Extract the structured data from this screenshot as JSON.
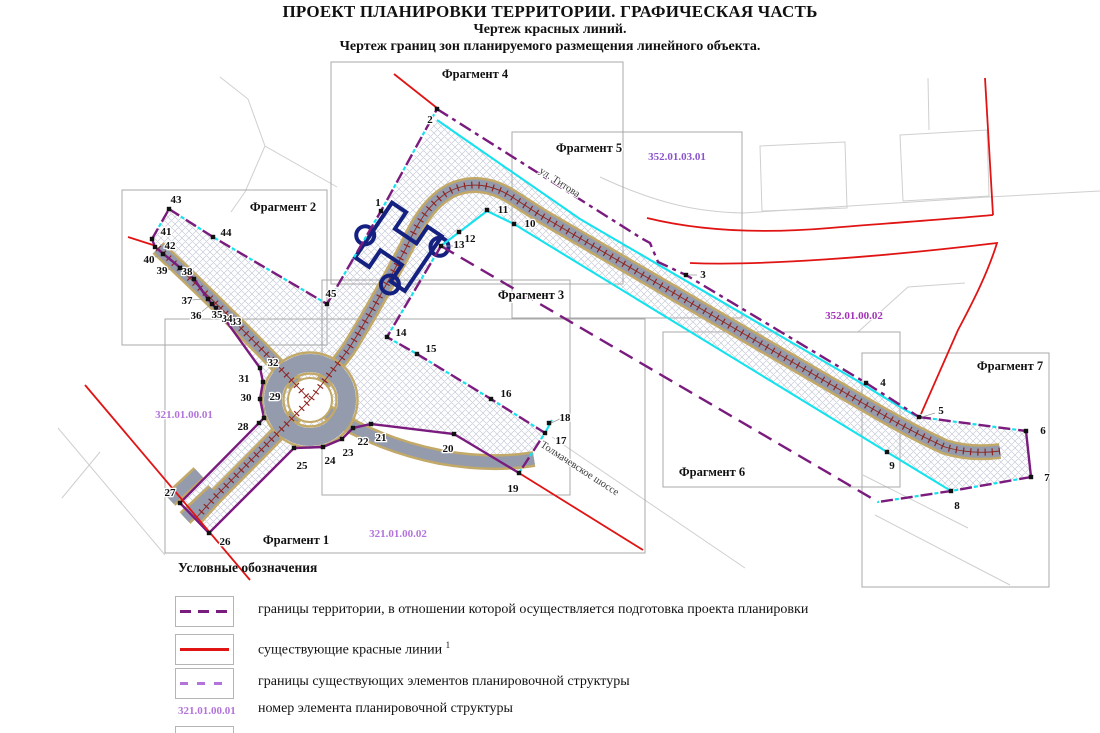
{
  "title": {
    "line1": "ПРОЕКТ ПЛАНИРОВКИ ТЕРРИТОРИИ. ГРАФИЧЕСКАЯ ЧАСТЬ",
    "line2": "Чертеж красных линий.",
    "line3": "Чертеж границ зон планируемого размещения линейного объекта."
  },
  "fragments": [
    {
      "label": "Фрагмент 1"
    },
    {
      "label": "Фрагмент 2"
    },
    {
      "label": "Фрагмент 3"
    },
    {
      "label": "Фрагмент 4"
    },
    {
      "label": "Фрагмент 5"
    },
    {
      "label": "Фрагмент 6"
    },
    {
      "label": "Фрагмент 7"
    }
  ],
  "zones": [
    {
      "code": "321.01.00.01"
    },
    {
      "code": "321.01.00.02"
    },
    {
      "code": "352.01.03.01"
    },
    {
      "code": "352.01.00.02"
    }
  ],
  "streets": [
    {
      "name": "ул. Титова"
    },
    {
      "name": "Толмачевское шоссе"
    }
  ],
  "legend": {
    "heading": "Условные обозначения",
    "items": [
      {
        "swatch": "boundary-dashed",
        "label": "границы территории, в отношении которой осуществляется подготовка проекта планировки"
      },
      {
        "swatch": "red-line",
        "label": "существующие красные линии",
        "superscript": "1"
      },
      {
        "swatch": "struct-dashed",
        "label": "границы существующих элементов планировочной структуры"
      },
      {
        "swatch": "code",
        "code": "321.01.00.01",
        "label": "номер элемента планировочной структуры"
      }
    ]
  },
  "points": [
    {
      "n": 1,
      "x": 381,
      "y": 211,
      "lx": 378,
      "ly": 206
    },
    {
      "n": 2,
      "x": 437,
      "y": 109,
      "lx": 430,
      "ly": 123
    },
    {
      "n": 3,
      "x": 686,
      "y": 275,
      "lx": 703,
      "ly": 278
    },
    {
      "n": 4,
      "x": 866,
      "y": 383,
      "lx": 883,
      "ly": 386
    },
    {
      "n": 5,
      "x": 919,
      "y": 417,
      "lx": 941,
      "ly": 414
    },
    {
      "n": 6,
      "x": 1026,
      "y": 431,
      "lx": 1043,
      "ly": 434
    },
    {
      "n": 7,
      "x": 1031,
      "y": 477,
      "lx": 1047,
      "ly": 481
    },
    {
      "n": 8,
      "x": 951,
      "y": 491,
      "lx": 957,
      "ly": 509
    },
    {
      "n": 9,
      "x": 887,
      "y": 452,
      "lx": 892,
      "ly": 469
    },
    {
      "n": 10,
      "x": 514,
      "y": 224,
      "lx": 530,
      "ly": 227
    },
    {
      "n": 11,
      "x": 487,
      "y": 210,
      "lx": 503,
      "ly": 213
    },
    {
      "n": 12,
      "x": 459,
      "y": 232,
      "lx": 470,
      "ly": 242
    },
    {
      "n": 13,
      "x": 441,
      "y": 246,
      "lx": 459,
      "ly": 248
    },
    {
      "n": 14,
      "x": 387,
      "y": 337,
      "lx": 401,
      "ly": 336
    },
    {
      "n": 15,
      "x": 417,
      "y": 354,
      "lx": 431,
      "ly": 352
    },
    {
      "n": 16,
      "x": 491,
      "y": 399,
      "lx": 506,
      "ly": 397
    },
    {
      "n": 17,
      "x": 545,
      "y": 433,
      "lx": 561,
      "ly": 444
    },
    {
      "n": 18,
      "x": 549,
      "y": 423,
      "lx": 565,
      "ly": 421
    },
    {
      "n": 19,
      "x": 519,
      "y": 473,
      "lx": 513,
      "ly": 492
    },
    {
      "n": 20,
      "x": 454,
      "y": 434,
      "lx": 448,
      "ly": 452
    },
    {
      "n": 21,
      "x": 371,
      "y": 424,
      "lx": 381,
      "ly": 441
    },
    {
      "n": 22,
      "x": 353,
      "y": 428,
      "lx": 363,
      "ly": 445
    },
    {
      "n": 23,
      "x": 342,
      "y": 439,
      "lx": 348,
      "ly": 456
    },
    {
      "n": 24,
      "x": 323,
      "y": 447,
      "lx": 330,
      "ly": 464
    },
    {
      "n": 25,
      "x": 294,
      "y": 448,
      "lx": 302,
      "ly": 469
    },
    {
      "n": 26,
      "x": 209,
      "y": 533,
      "lx": 225,
      "ly": 545
    },
    {
      "n": 27,
      "x": 180,
      "y": 503,
      "lx": 170,
      "ly": 496
    },
    {
      "n": 28,
      "x": 259,
      "y": 423,
      "lx": 243,
      "ly": 430
    },
    {
      "n": 29,
      "x": 264,
      "y": 418,
      "lx": 275,
      "ly": 400
    },
    {
      "n": 30,
      "x": 260,
      "y": 399,
      "lx": 246,
      "ly": 401
    },
    {
      "n": 31,
      "x": 263,
      "y": 382,
      "lx": 244,
      "ly": 382
    },
    {
      "n": 32,
      "x": 260,
      "y": 368,
      "lx": 273,
      "ly": 366
    },
    {
      "n": 33,
      "x": 224,
      "y": 318,
      "lx": 236,
      "ly": 325
    },
    {
      "n": 34,
      "x": 220,
      "y": 313,
      "lx": 227,
      "ly": 322
    },
    {
      "n": 35,
      "x": 216,
      "y": 308,
      "lx": 217,
      "ly": 318
    },
    {
      "n": 36,
      "x": 212,
      "y": 304,
      "lx": 196,
      "ly": 319
    },
    {
      "n": 37,
      "x": 208,
      "y": 299,
      "lx": 187,
      "ly": 304
    },
    {
      "n": 38,
      "x": 194,
      "y": 279,
      "lx": 187,
      "ly": 275
    },
    {
      "n": 39,
      "x": 180,
      "y": 268,
      "lx": 162,
      "ly": 274
    },
    {
      "n": 40,
      "x": 163,
      "y": 254,
      "lx": 149,
      "ly": 263
    },
    {
      "n": 41,
      "x": 152,
      "y": 239,
      "lx": 166,
      "ly": 235
    },
    {
      "n": 42,
      "x": 155,
      "y": 247,
      "lx": 170,
      "ly": 249
    },
    {
      "n": 43,
      "x": 169,
      "y": 209,
      "lx": 176,
      "ly": 203
    },
    {
      "n": 44,
      "x": 213,
      "y": 237,
      "lx": 226,
      "ly": 236
    },
    {
      "n": 45,
      "x": 327,
      "y": 304,
      "lx": 331,
      "ly": 297
    }
  ],
  "colors": {
    "boundary_purple": "#7A1B7E",
    "existing_red": "#E11414",
    "struct_purple": "#B273DB",
    "zone_cyan": "#16E2EE",
    "zone_code_violet": "#8A52CC",
    "zone_code_magenta": "#A233B8",
    "road_fill": "#949BAD",
    "road_edge": "#C2A968",
    "tick_red": "#8E2420",
    "building_navy": "#152180"
  }
}
